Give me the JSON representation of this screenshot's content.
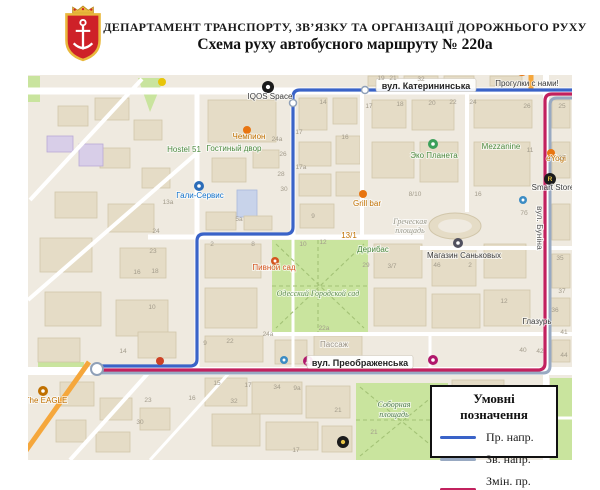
{
  "header": {
    "line1": "ДЕПАРТАМЕНТ ТРАНСПОРТУ, ЗВ’ЯЗКУ ТА ОРГАНІЗАЦІЇ ДОРОЖНЬОГО РУХУ",
    "line2": "Схема руху автобусного маршруту № 220а"
  },
  "legend": {
    "title": "Умовні позначення",
    "items": [
      {
        "label": "Пр. напр.",
        "color": "#3A63C8"
      },
      {
        "label": "Зв. напр.",
        "color": "#98A9C2"
      },
      {
        "label": "Змін. пр. напр.",
        "color": "#C2215E"
      }
    ]
  },
  "map": {
    "colors": {
      "base": "#EFEAE0",
      "road": "#FFFFFF",
      "green": "#C9E49E",
      "bld": "#E5DCC6",
      "bldStroke": "#D1C6AA"
    },
    "greens": [
      {
        "r": [
          272,
          240,
          96,
          92
        ]
      },
      {
        "r": [
          356,
          383,
          92,
          77
        ]
      },
      {
        "r": [
          550,
          378,
          22,
          82
        ]
      },
      {
        "r": [
          28,
          76,
          12,
          26
        ]
      },
      {
        "r": [
          38,
          362,
          46,
          8
        ]
      },
      {
        "p": "138,78 164,78 150,112"
      }
    ],
    "parkDashes": [
      "M276,244 L364,328",
      "M364,244 L276,328",
      "M272,286 H368",
      "M318,240 V332",
      "M360,387 L444,456",
      "M444,387 L360,456",
      "M356,420 H446"
    ],
    "buildings": [
      [
        95,
        98,
        34,
        22
      ],
      [
        134,
        120,
        28,
        20
      ],
      [
        58,
        106,
        30,
        20
      ],
      [
        100,
        148,
        30,
        20
      ],
      [
        142,
        168,
        28,
        20
      ],
      [
        47,
        136,
        26,
        16,
        "p"
      ],
      [
        79,
        144,
        24,
        22,
        "p"
      ],
      [
        55,
        192,
        42,
        26
      ],
      [
        108,
        204,
        46,
        28
      ],
      [
        40,
        238,
        52,
        34
      ],
      [
        120,
        248,
        46,
        30
      ],
      [
        45,
        292,
        56,
        34
      ],
      [
        116,
        300,
        52,
        36
      ],
      [
        38,
        338,
        42,
        24
      ],
      [
        138,
        332,
        38,
        26
      ],
      [
        208,
        100,
        68,
        42
      ],
      [
        212,
        158,
        34,
        24
      ],
      [
        253,
        150,
        26,
        18
      ],
      [
        237,
        190,
        20,
        27,
        "b"
      ],
      [
        206,
        212,
        30,
        18
      ],
      [
        244,
        216,
        28,
        14
      ],
      [
        299,
        98,
        28,
        32
      ],
      [
        333,
        98,
        24,
        26
      ],
      [
        299,
        142,
        32,
        24
      ],
      [
        336,
        136,
        24,
        28
      ],
      [
        299,
        174,
        32,
        22
      ],
      [
        336,
        172,
        26,
        24
      ],
      [
        300,
        204,
        34,
        24
      ],
      [
        368,
        76,
        30,
        10
      ],
      [
        404,
        76,
        34,
        10
      ],
      [
        444,
        76,
        30,
        10
      ],
      [
        490,
        76,
        32,
        10
      ],
      [
        372,
        100,
        34,
        28
      ],
      [
        412,
        100,
        42,
        30
      ],
      [
        372,
        142,
        42,
        36
      ],
      [
        420,
        142,
        38,
        40
      ],
      [
        474,
        100,
        58,
        28
      ],
      [
        474,
        142,
        56,
        44
      ],
      [
        552,
        100,
        18,
        28
      ],
      [
        552,
        142,
        18,
        36
      ],
      [
        552,
        204,
        18,
        36
      ],
      [
        552,
        254,
        18,
        34
      ],
      [
        550,
        298,
        20,
        28
      ],
      [
        552,
        340,
        18,
        22
      ],
      [
        205,
        244,
        56,
        34
      ],
      [
        205,
        288,
        52,
        40
      ],
      [
        205,
        336,
        58,
        26
      ],
      [
        275,
        340,
        32,
        24
      ],
      [
        314,
        336,
        48,
        28
      ],
      [
        374,
        244,
        48,
        34
      ],
      [
        374,
        288,
        52,
        38
      ],
      [
        432,
        248,
        44,
        38
      ],
      [
        432,
        294,
        48,
        34
      ],
      [
        484,
        244,
        42,
        34
      ],
      [
        484,
        290,
        46,
        36
      ],
      [
        205,
        378,
        42,
        28
      ],
      [
        252,
        382,
        50,
        32
      ],
      [
        306,
        386,
        44,
        32
      ],
      [
        212,
        414,
        48,
        32
      ],
      [
        266,
        422,
        52,
        28
      ],
      [
        322,
        426,
        30,
        26
      ],
      [
        60,
        382,
        34,
        24
      ],
      [
        100,
        398,
        32,
        22
      ],
      [
        56,
        420,
        30,
        22
      ],
      [
        96,
        432,
        34,
        20
      ],
      [
        140,
        408,
        30,
        22
      ],
      [
        452,
        380,
        52,
        26
      ]
    ],
    "oval": {
      "cx": 455,
      "cy": 226,
      "rx": 26,
      "ry": 13
    },
    "roadsH": [
      {
        "y": 91,
        "x1": 28,
        "x2": 572,
        "w": 7
      },
      {
        "y": 237,
        "x1": 148,
        "x2": 424,
        "w": 5
      },
      {
        "y": 248,
        "x1": 420,
        "x2": 572,
        "w": 4
      },
      {
        "y": 334,
        "x1": 268,
        "x2": 572,
        "w": 4
      },
      {
        "y": 371,
        "x1": 28,
        "x2": 572,
        "w": 8
      },
      {
        "y": 418,
        "x1": 446,
        "x2": 572,
        "w": 3
      }
    ],
    "roadsV": [
      {
        "x": 197,
        "y1": 91,
        "y2": 371,
        "w": 5
      },
      {
        "x": 293,
        "y1": 91,
        "y2": 237,
        "w": 5
      },
      {
        "x": 293,
        "y1": 237,
        "y2": 371,
        "w": 3
      },
      {
        "x": 362,
        "y1": 91,
        "y2": 237,
        "w": 4
      },
      {
        "x": 467,
        "y1": 91,
        "y2": 212,
        "w": 4
      },
      {
        "x": 546,
        "y1": 75,
        "y2": 460,
        "w": 6
      },
      {
        "x": 430,
        "y1": 334,
        "y2": 371,
        "w": 3
      }
    ],
    "roadsD": [
      {
        "x1": 30,
        "y1": 200,
        "x2": 142,
        "y2": 79,
        "w": 4
      },
      {
        "x1": 28,
        "y1": 300,
        "x2": 197,
        "y2": 153,
        "w": 4
      },
      {
        "x1": 150,
        "y1": 371,
        "x2": 70,
        "y2": 460,
        "w": 4
      },
      {
        "x1": 230,
        "y1": 372,
        "x2": 150,
        "y2": 460,
        "w": 3
      },
      {
        "x1": 89,
        "y1": 362,
        "x2": 25,
        "y2": 452,
        "w": 5,
        "c": "#F5A73C"
      },
      {
        "x1": 531,
        "y1": 75,
        "x2": 531,
        "y2": 89,
        "w": 5,
        "c": "#F5A73C"
      }
    ],
    "routes": [
      {
        "name": "return-direction",
        "color": "#98A9C2",
        "w": 3,
        "pts": [
          [
            572,
            98
          ],
          [
            550,
            98
          ],
          [
            550,
            373
          ],
          [
            99,
            373
          ]
        ]
      },
      {
        "name": "changed-forward-direction",
        "color": "#C2215E",
        "w": 3.2,
        "pts": [
          [
            572,
            94
          ],
          [
            545,
            94
          ],
          [
            545,
            370
          ],
          [
            99,
            370
          ]
        ]
      },
      {
        "name": "forward-direction",
        "color": "#3A63C8",
        "w": 3.2,
        "pts": [
          [
            572,
            90
          ],
          [
            293,
            90
          ],
          [
            293,
            234
          ],
          [
            197,
            234
          ],
          [
            197,
            366
          ],
          [
            99,
            366
          ]
        ]
      }
    ],
    "waypoints": [
      {
        "x": 365,
        "y": 90,
        "r": 3.5
      },
      {
        "x": 293,
        "y": 103,
        "r": 3.5
      },
      {
        "x": 97,
        "y": 369,
        "r": 6
      }
    ],
    "streetBoxes": [
      {
        "t": "вул. Катерининська",
        "x": 426,
        "y": 86,
        "w": 100,
        "h": 13
      },
      {
        "t": "вул. Преображенська",
        "x": 360,
        "y": 363,
        "w": 106,
        "h": 13
      }
    ],
    "vstreet": {
      "t": "вул. Буніна",
      "x": 537,
      "y": 206
    },
    "labels": [
      {
        "t": "IQOS Space",
        "x": 270,
        "y": 99,
        "c": "#3a3a3a"
      },
      {
        "t": "Чемпион",
        "x": 249,
        "y": 139,
        "c": "#C07000"
      },
      {
        "t": "Hostel 51",
        "x": 184,
        "y": 152,
        "c": "#4C8A3F"
      },
      {
        "t": "Гостиный двор",
        "x": 234,
        "y": 151,
        "c": "#4C8A3F"
      },
      {
        "t": "Гали-Сервис",
        "x": 200,
        "y": 198,
        "c": "#1272CC"
      },
      {
        "t": "Эко Планета",
        "x": 434,
        "y": 158,
        "c": "#4C8A3F"
      },
      {
        "t": "Mezzanine",
        "x": 501,
        "y": 149,
        "c": "#4C8A3F"
      },
      {
        "t": "Grill bar",
        "x": 367,
        "y": 206,
        "c": "#C07000"
      },
      {
        "t": "Пивной сад",
        "x": 274,
        "y": 270,
        "c": "#D4541E"
      },
      {
        "t": "Греческая",
        "x": 410,
        "y": 224,
        "c": "#99988A",
        "i": 1
      },
      {
        "t": "площадь",
        "x": 410,
        "y": 233,
        "c": "#99988A",
        "i": 1
      },
      {
        "t": "Дерибас",
        "x": 373,
        "y": 252,
        "c": "#4C8A3F"
      },
      {
        "t": "Магазин Саньковых",
        "x": 464,
        "y": 258,
        "c": "#3a3a3a"
      },
      {
        "t": "Одесский Городской сад",
        "x": 318,
        "y": 296,
        "c": "#5F8F4F",
        "i": 1
      },
      {
        "t": "Соборная",
        "x": 394,
        "y": 407,
        "c": "#4F7A4F",
        "i": 1
      },
      {
        "t": "площадь",
        "x": 394,
        "y": 417,
        "c": "#4F7A4F",
        "i": 1
      },
      {
        "t": "The EAGLE",
        "x": 46,
        "y": 403,
        "c": "#C07000"
      },
      {
        "t": "Прогулки с нами!",
        "x": 527,
        "y": 86,
        "c": "#3a3a3a"
      },
      {
        "t": "Smart Store",
        "x": 553,
        "y": 190,
        "c": "#3a3a3a"
      },
      {
        "t": "eYogi",
        "x": 556,
        "y": 161,
        "c": "#C07000"
      },
      {
        "t": "Пассаж",
        "x": 334,
        "y": 347,
        "c": "#9A9285"
      },
      {
        "t": "Глазурь",
        "x": 537,
        "y": 324,
        "c": "#3a3a3a"
      },
      {
        "t": "13/1",
        "x": 349,
        "y": 238,
        "c": "#C07000"
      }
    ],
    "numbers": [
      [
        "19",
        381,
        80
      ],
      [
        "21",
        393,
        80
      ],
      [
        "32",
        421,
        81
      ],
      [
        "17",
        369,
        108
      ],
      [
        "18",
        400,
        106
      ],
      [
        "20",
        432,
        105
      ],
      [
        "22",
        453,
        104
      ],
      [
        "24",
        473,
        104
      ],
      [
        "26",
        527,
        108
      ],
      [
        "25",
        562,
        108
      ],
      [
        "27",
        562,
        160
      ],
      [
        "14",
        323,
        104
      ],
      [
        "16",
        345,
        139
      ],
      [
        "17",
        299,
        134
      ],
      [
        "24а",
        277,
        141
      ],
      [
        "26",
        283,
        156
      ],
      [
        "17а",
        301,
        169
      ],
      [
        "28",
        281,
        176
      ],
      [
        "30",
        284,
        191
      ],
      [
        "13а",
        168,
        204
      ],
      [
        "24",
        156,
        233
      ],
      [
        "5а",
        239,
        221
      ],
      [
        "9",
        313,
        218
      ],
      [
        "11",
        530,
        152
      ],
      [
        "2",
        212,
        246
      ],
      [
        "8",
        253,
        246
      ],
      [
        "10",
        303,
        246
      ],
      [
        "12",
        323,
        244
      ],
      [
        "23",
        153,
        253
      ],
      [
        "16",
        137,
        274
      ],
      [
        "18",
        155,
        273
      ],
      [
        "10",
        152,
        309
      ],
      [
        "29",
        366,
        267
      ],
      [
        "3/7",
        392,
        268
      ],
      [
        "46",
        437,
        267
      ],
      [
        "2",
        470,
        267
      ],
      [
        "8/10",
        415,
        196
      ],
      [
        "16",
        478,
        196
      ],
      [
        "22а",
        324,
        330
      ],
      [
        "24а",
        268,
        336
      ],
      [
        "34",
        277,
        389
      ],
      [
        "9а",
        297,
        390
      ],
      [
        "32",
        234,
        403
      ],
      [
        "30",
        140,
        424
      ],
      [
        "21",
        374,
        434
      ],
      [
        "17",
        296,
        452
      ],
      [
        "35",
        560,
        260
      ],
      [
        "37",
        562,
        293
      ],
      [
        "41",
        564,
        334
      ],
      [
        "44",
        564,
        357
      ],
      [
        "12",
        504,
        303
      ],
      [
        "40",
        523,
        352
      ],
      [
        "42",
        540,
        353
      ],
      [
        "36",
        555,
        312
      ],
      [
        "21",
        338,
        412
      ],
      [
        "15",
        217,
        385
      ],
      [
        "17",
        248,
        387
      ],
      [
        "16",
        192,
        400
      ],
      [
        "23",
        148,
        402
      ],
      [
        "9",
        205,
        345
      ],
      [
        "22",
        230,
        343
      ],
      [
        "14",
        123,
        353
      ],
      [
        "7б",
        524,
        215
      ]
    ],
    "pois": [
      {
        "x": 268,
        "y": 87,
        "r": 6,
        "f": "#1b1b1b",
        "in": "#ffffff",
        "n": "iqos-space-icon"
      },
      {
        "x": 550,
        "y": 179,
        "r": 6,
        "f": "#1b1b1b",
        "g": "R",
        "fg": "#E8C547",
        "n": "smart-store-icon"
      },
      {
        "x": 343,
        "y": 442,
        "r": 6,
        "f": "#1b1b1b",
        "in": "#E8C547",
        "n": "poi-icon"
      },
      {
        "x": 458,
        "y": 243,
        "r": 5,
        "f": "#50505E",
        "in": "#ffffff",
        "n": "sankovy-store-icon"
      },
      {
        "x": 522,
        "y": 70,
        "r": 6,
        "f": "#E87511",
        "g": "Пн",
        "fg": "#ffffff",
        "n": "progulki-icon"
      },
      {
        "x": 308,
        "y": 361,
        "r": 5,
        "f": "#B0176B",
        "g": "Д",
        "fg": "#ffffff",
        "n": "bus-stop-icon"
      },
      {
        "x": 433,
        "y": 360,
        "r": 5,
        "f": "#B0176B",
        "in": "#ffffff",
        "n": "bus-stop-icon"
      },
      {
        "x": 284,
        "y": 360,
        "r": 4,
        "f": "#3C8CC4",
        "in": "#ffffff",
        "n": "info-icon"
      },
      {
        "x": 523,
        "y": 200,
        "r": 4,
        "f": "#3C8CC4",
        "in": "#ffffff",
        "n": "info-icon"
      },
      {
        "x": 199,
        "y": 186,
        "r": 5,
        "f": "#2B6CB8",
        "in": "#ffffff",
        "n": "gali-service-icon"
      },
      {
        "x": 433,
        "y": 144,
        "r": 5,
        "f": "#3BA05A",
        "in": "#ffffff",
        "n": "eco-planeta-icon"
      },
      {
        "x": 363,
        "y": 194,
        "r": 4,
        "f": "#E87511",
        "n": "restaurant-icon"
      },
      {
        "x": 551,
        "y": 153,
        "r": 4,
        "f": "#E87511",
        "n": "restaurant-icon"
      },
      {
        "x": 43,
        "y": 391,
        "r": 5,
        "f": "#C07000",
        "in": "#ffffff",
        "n": "cafe-icon"
      },
      {
        "x": 247,
        "y": 130,
        "r": 4,
        "f": "#E87511",
        "n": "shop-icon"
      },
      {
        "x": 275,
        "y": 261,
        "r": 4,
        "f": "#D4541E",
        "in": "#ffffff",
        "n": "beer-garden-icon"
      },
      {
        "x": 160,
        "y": 361,
        "r": 4,
        "f": "#CC4125",
        "n": "poi-icon"
      },
      {
        "x": 162,
        "y": 82,
        "r": 4,
        "f": "#E8C50A",
        "n": "poi-icon"
      }
    ]
  }
}
